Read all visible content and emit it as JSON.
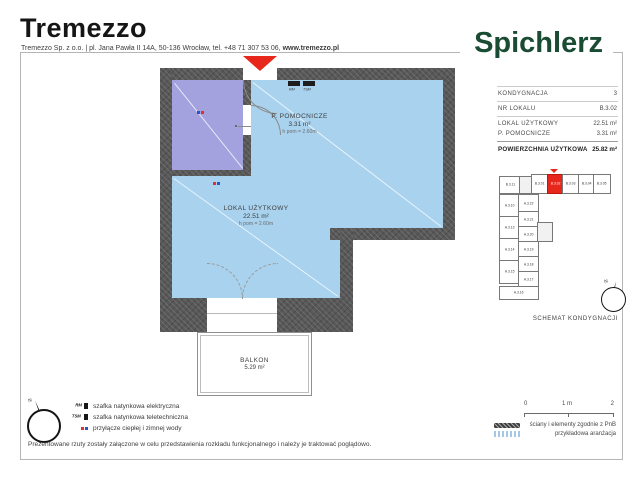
{
  "header": {
    "logo": "Tremezzo",
    "address": "Tremezzo Sp. z o.o. | pl. Jana Pawła II 14A, 50-136 Wrocław, tel. +48 71 307 53 06, ",
    "website": "www.tremezzo.pl",
    "project": "Spichlerz"
  },
  "plan": {
    "rooms": [
      {
        "name": "P. POMOCNICZE",
        "area": "3.31 m²",
        "height": "h pom = 2.60m"
      },
      {
        "name": "LOKAL UŻYTKOWY",
        "area": "22.51 m²",
        "height": "h pom = 2.60m"
      },
      {
        "name": "BALKON",
        "area": "5.29 m²"
      }
    ],
    "wall_labels": {
      "rm": "RM",
      "tsm": "TSM"
    }
  },
  "info_table": {
    "rows": [
      {
        "label": "KONDYGNACJA",
        "value": "3"
      },
      {
        "label": "NR LOKALU",
        "value": "B.3.02"
      },
      {
        "label": "LOKAL UŻYTKOWY",
        "value": "22.51 m²"
      },
      {
        "label": "P. POMOCNICZE",
        "value": "3.31 m²"
      }
    ],
    "total": {
      "label": "POWIERZCHNIA UŻYTKOWA",
      "value": "25.82 m²"
    }
  },
  "schematic": {
    "caption": "SCHEMAT KONDYGNACJI",
    "highlighted_unit": "B.3.02",
    "units": [
      "B.3.11",
      "B.3.01",
      "B.3.02",
      "B.3.03",
      "B.3.04",
      "B.3.05",
      "A.3.10",
      "A.3.13",
      "A.3.14",
      "A.3.15",
      "A.3.22",
      "A.3.21",
      "A.3.20",
      "A.3.19",
      "A.3.18",
      "A.3.17",
      "A.3.16"
    ]
  },
  "compass": {
    "n": "N"
  },
  "legend": {
    "items": [
      {
        "icon": "rm-cabinet-icon",
        "icon_label": "RM",
        "text": "szafka natynkowa elektryczna"
      },
      {
        "icon": "tsm-cabinet-icon",
        "icon_label": "TSM",
        "text": "szafka natynkowa teletechniczna"
      },
      {
        "icon": "water-connection-icon",
        "icon_label": "",
        "text": "przyłącze ciepłej i zimnej wody"
      }
    ]
  },
  "scale_bar": {
    "labels": [
      "0",
      "1 m",
      "2"
    ]
  },
  "right_legend": [
    {
      "type": "walls",
      "text": "ściany i elementy zgodnie z PnB"
    },
    {
      "type": "arrangement",
      "text": "przykładowa aranżacja"
    }
  ],
  "disclaimer": "Prezentowane rzuty zostały załączone w celu przedstawienia rozkładu funkcjonalnego i należy je traktować poglądowo.",
  "colors": {
    "accent_red": "#e8271c",
    "brand_green": "#1a4c33",
    "room_blue": "#a8d2ee",
    "room_purple": "#a3a2de",
    "wall_gray": "#585858"
  }
}
